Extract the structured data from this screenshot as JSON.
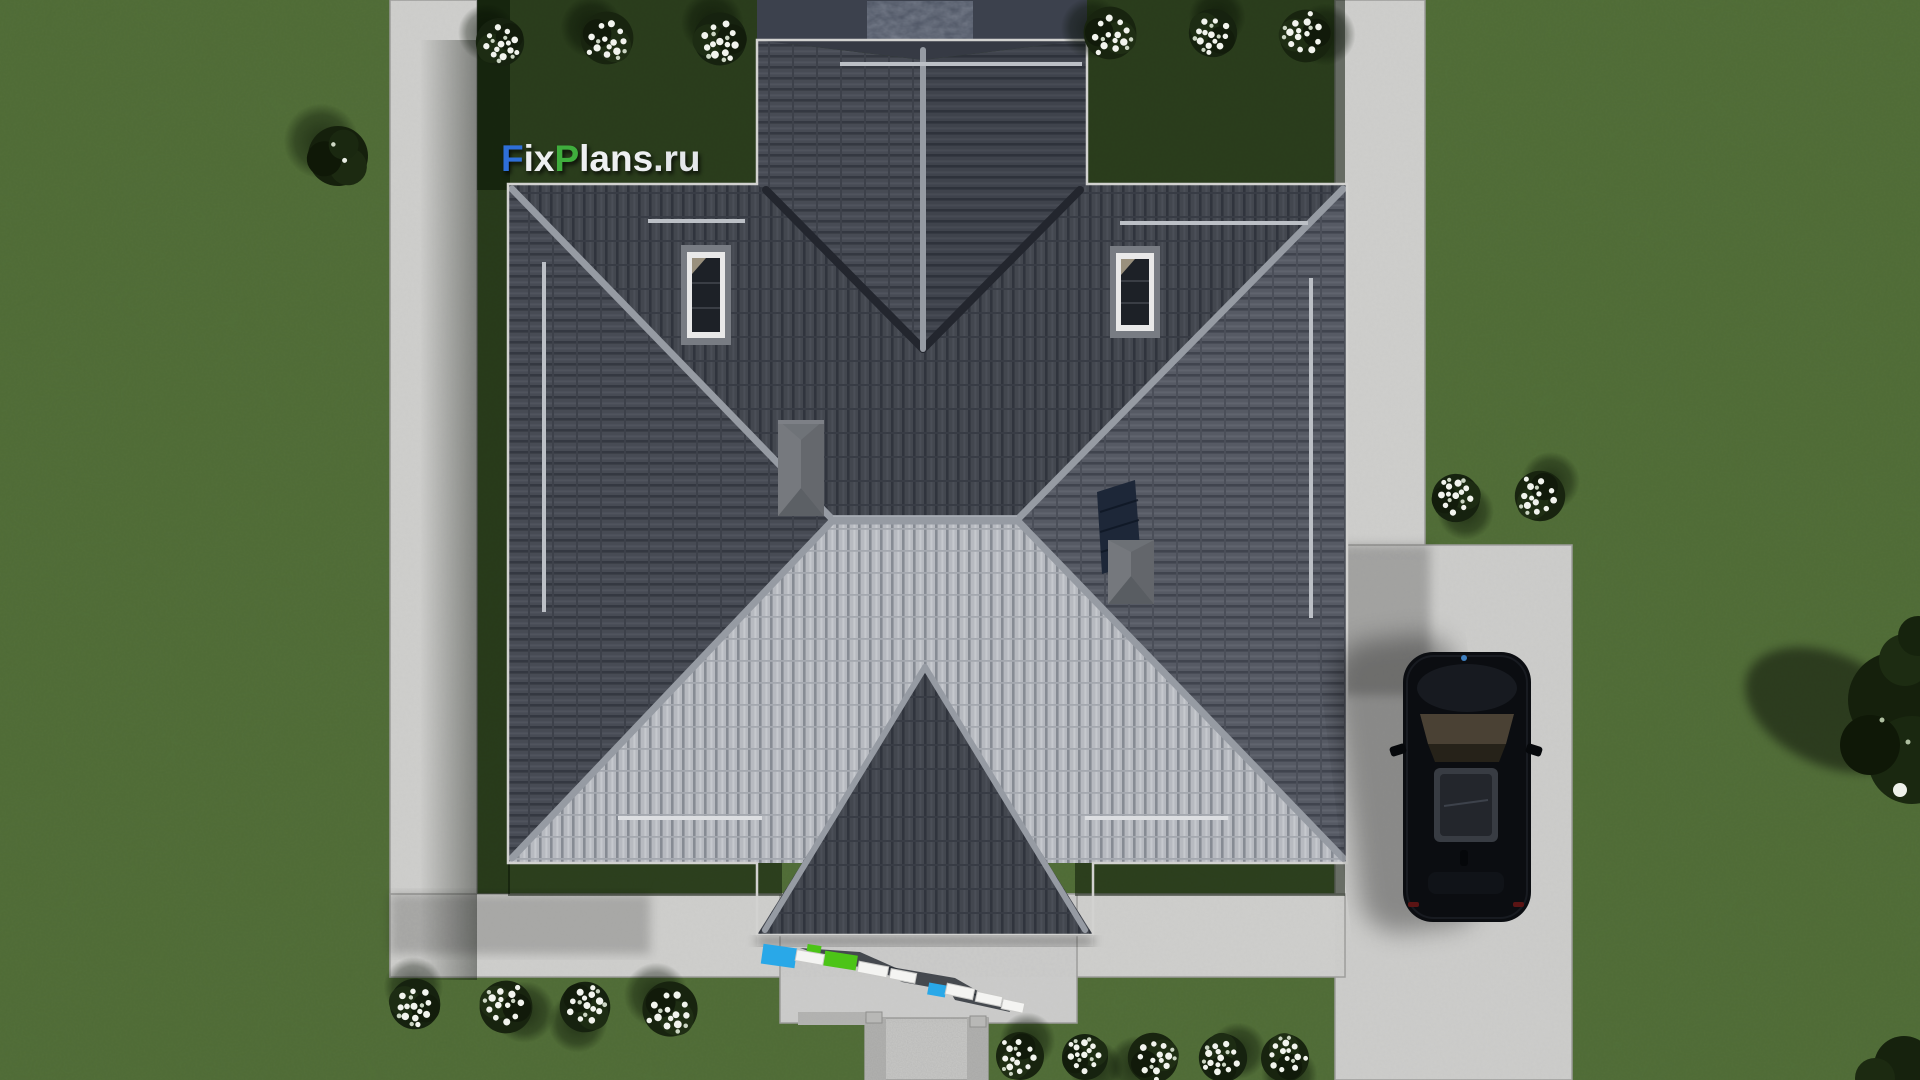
{
  "image_type": "3d aerial architectural render (top-down site view)",
  "watermark": {
    "text": "FixPlans.ru",
    "segments": [
      {
        "text": "F",
        "color": "#2e6fd8"
      },
      {
        "text": "ix",
        "color": "#edeff1"
      },
      {
        "text": "P",
        "color": "#3fae3d"
      },
      {
        "text": "lans",
        "color": "#edeff1"
      },
      {
        "text": ".ru",
        "color": "#e4e7ea"
      }
    ]
  },
  "palette": {
    "lawn_green": "#4e6a35",
    "lawn_shadow": "#14230e",
    "concrete": "#cfcfcd",
    "gravel_edge": "#b2b2b0",
    "roof_tile_dark": "#43474f",
    "roof_tile_light": "#b7bac0",
    "roof_ridge": "#969ba3",
    "roof_valley": "#23262e",
    "slate_terrace": "#3c414d",
    "skylight_frame": "#e9e9e9",
    "chimney_gray": "#6f7378",
    "solar_panel_navy": "#1d2738",
    "car_black": "#0b0d11",
    "car_sunroof": "#24272d",
    "flower_white": "#f2f4ee",
    "accent_blue_object": "#29a8e8",
    "accent_green_object": "#4cc417"
  },
  "scene": {
    "house": {
      "roof_style": "cross hip roof, dark tiles, sunlit light south plane",
      "skylight_count": 2,
      "chimney_count": 2,
      "solar_panel_count": 1,
      "snow_guard_bars": 6
    },
    "car": {
      "type": "black SUV, top view, parked on driveway",
      "color": "#0b0d11"
    },
    "vegetation": {
      "white_flower_bushes": 17,
      "dark_shrubs": 3
    },
    "hardscape": {
      "left_path": true,
      "right_path": true,
      "bottom_band": true,
      "driveway": true,
      "entry_walkway_with_gravel_edges": true
    },
    "porch_objects": [
      "white railing segments",
      "blue mat",
      "green mat",
      "small blue object"
    ]
  }
}
